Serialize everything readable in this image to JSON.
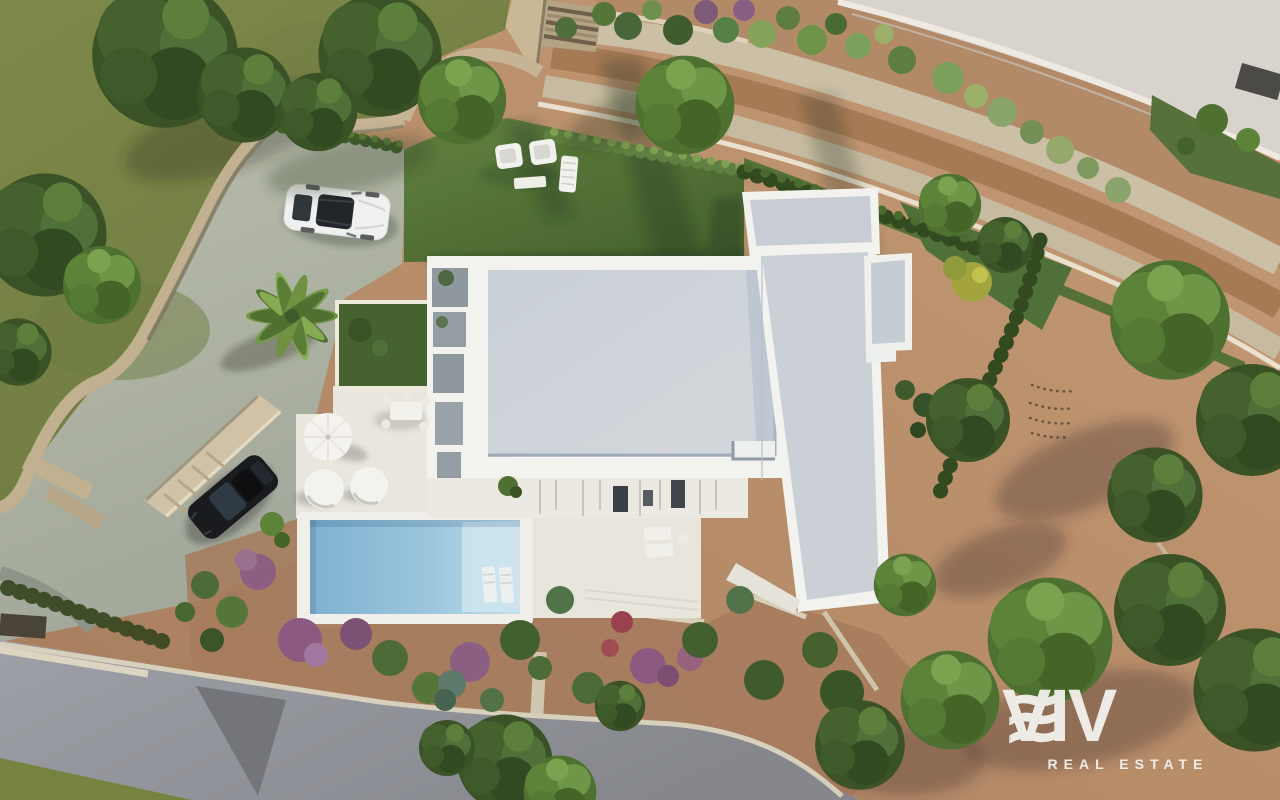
{
  "watermark": {
    "brand": "VIV",
    "brand_mark_icon": "triple-wave-e-icon",
    "brand_mark_outline_icon": "triple-wave-e-outline-icon",
    "tagline": "REAL ESTATE"
  },
  "palette": {
    "olive_grass": "#7b8549",
    "lawn_green": "#5e7d3e",
    "terracotta_dirt": "#b98f6d",
    "stone_path": "#cbbfa6",
    "path_brown": "#a67a55",
    "stone_wall": "#c2b191",
    "roof_gray": "#ccd1d8",
    "parapet_white": "#f2f2ef",
    "terrace_white": "#e9e6de",
    "pool_blue": "#a9cde2",
    "road_light": "#d8d4cd",
    "road_dark": "#909298",
    "watermark_white": "#f4f2ee"
  }
}
